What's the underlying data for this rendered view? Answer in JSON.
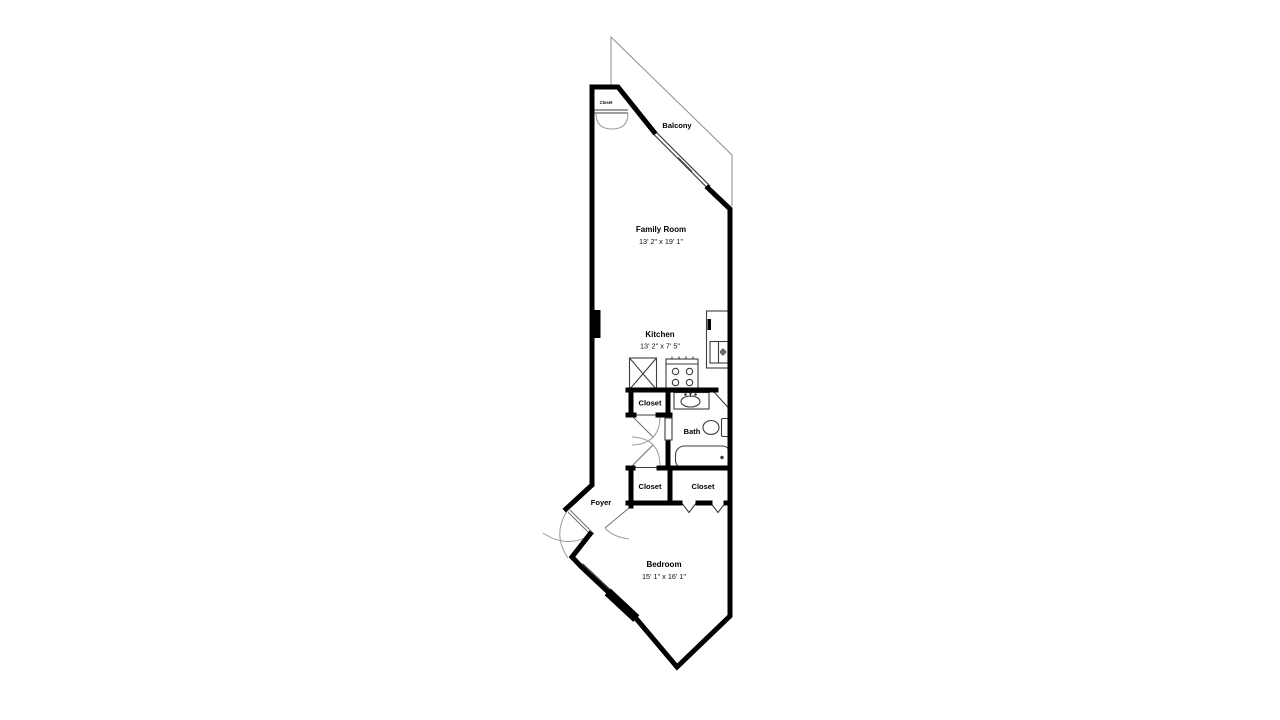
{
  "floorplan": {
    "labels": {
      "closet_top": "Closet",
      "balcony": "Balcony",
      "family_room": "Family Room",
      "family_room_dims": "13' 2\" x 19' 1\"",
      "kitchen": "Kitchen",
      "kitchen_dims": "13' 2\" x 7' 5\"",
      "closet_hall": "Closet",
      "bath": "Bath",
      "closet_bedroom_left": "Closet",
      "closet_bedroom_right": "Closet",
      "foyer": "Foyer",
      "bedroom": "Bedroom",
      "bedroom_dims": "15' 1\" x 16' 1\""
    },
    "fixtures": [
      "refrigerator-icon",
      "stove-icon",
      "kitchen-sink-icon",
      "bath-sink-icon",
      "toilet-icon",
      "bathtub-icon",
      "door-swing-icon",
      "bifold-door-icon",
      "sliding-door-icon",
      "window-icon"
    ],
    "colors": {
      "wall": "#000000",
      "fixture": "#3d3d3d",
      "door_arc": "#9b9b9b",
      "background": "#ffffff"
    }
  }
}
